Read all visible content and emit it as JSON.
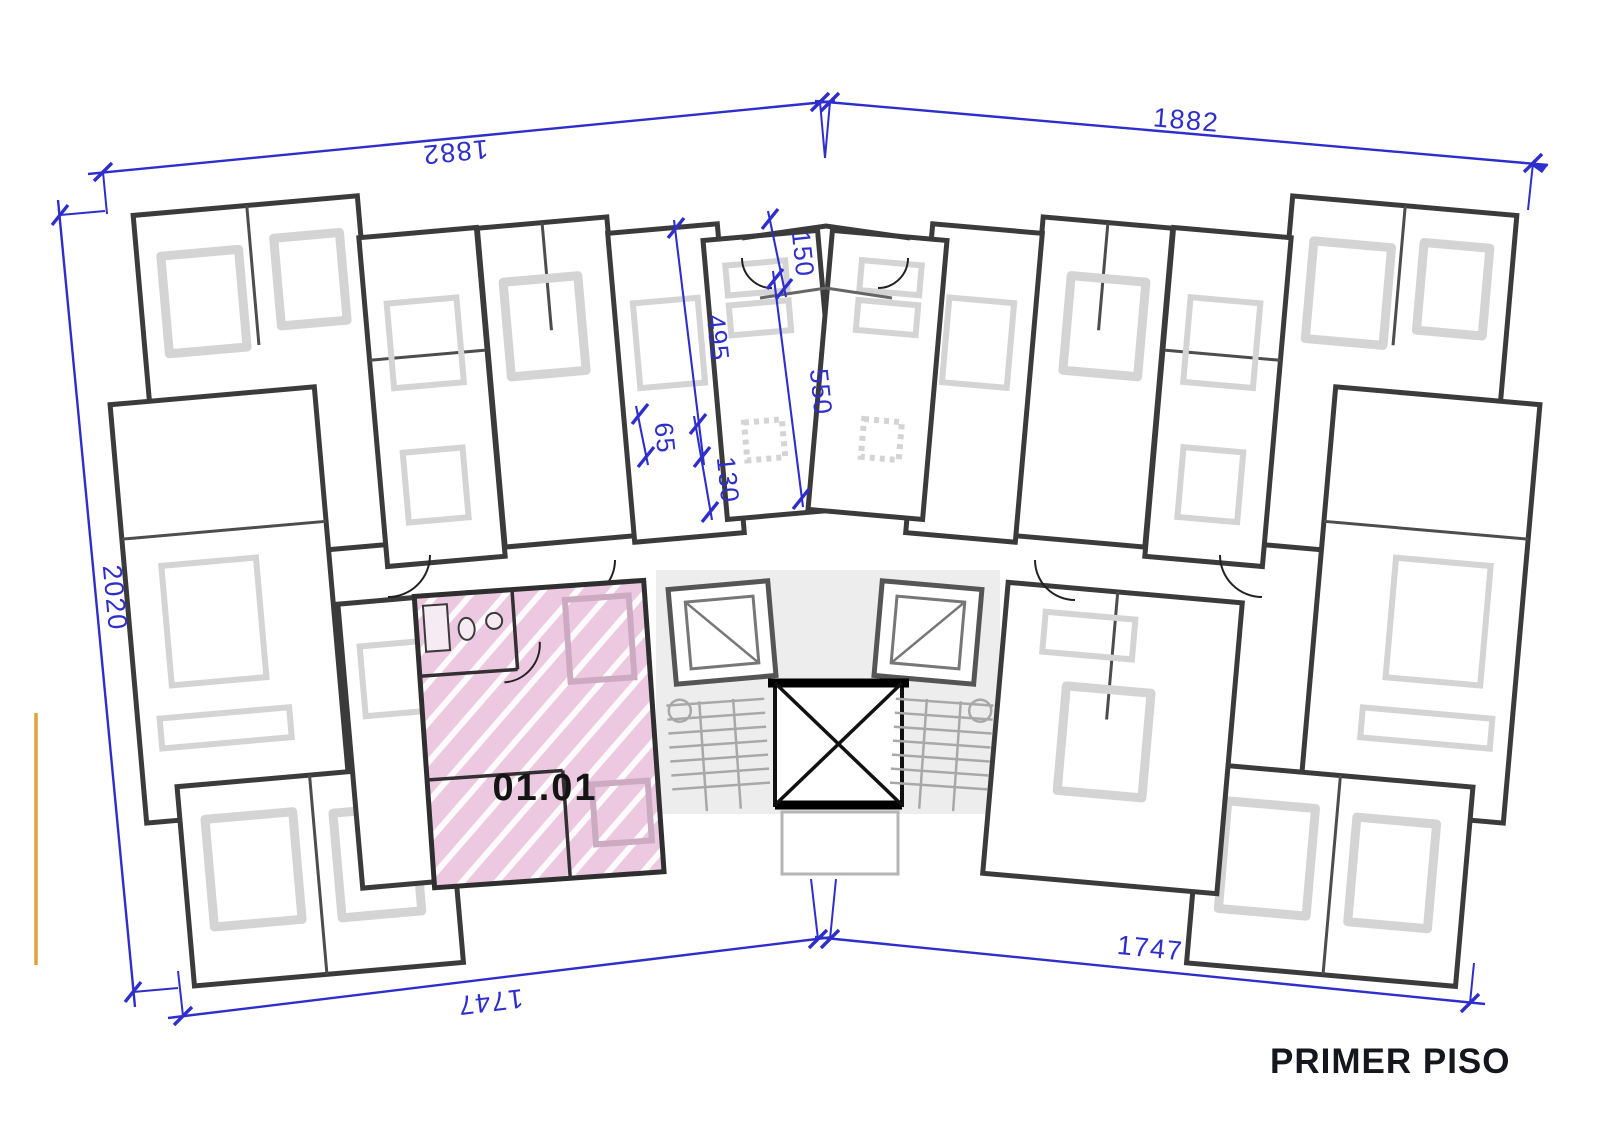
{
  "title": "PRIMER PISO",
  "highlighted_unit": {
    "label": "01.01"
  },
  "dimensions": {
    "top_left": "1882",
    "top_right": "1882",
    "left": "2020",
    "bottom_left": "1747",
    "bottom_right": "1747",
    "interior": [
      {
        "name": "dim-150",
        "value": "150"
      },
      {
        "name": "dim-495",
        "value": "495"
      },
      {
        "name": "dim-550",
        "value": "550"
      },
      {
        "name": "dim-65",
        "value": "65"
      },
      {
        "name": "dim-130",
        "value": "130"
      }
    ]
  },
  "colors": {
    "dimension-blue": "#2e2ecc",
    "highlight-pink": "#ecc9e1",
    "wall-dark": "#3b3b3b",
    "furniture-gray": "#d4d4d4",
    "core-gray": "#ededed",
    "marker-orange": "#e0a23c",
    "label-black": "#141414",
    "title-black": "#16161e"
  }
}
